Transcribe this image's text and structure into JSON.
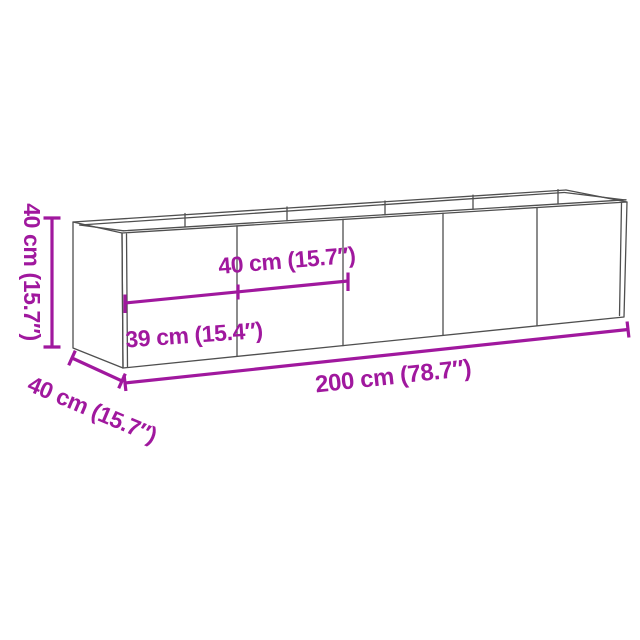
{
  "diagram": {
    "type": "product-dimension-drawing",
    "background": "#ffffff",
    "panel_count": 5,
    "dimensions": [
      {
        "id": "height",
        "label": "40 cm (15.7″)",
        "cm": 40,
        "inches": 15.7
      },
      {
        "id": "depth",
        "label": "40 cm (15.7″)",
        "cm": 40,
        "inches": 15.7
      },
      {
        "id": "panel_width",
        "label": "40 cm (15.7″)",
        "cm": 40,
        "inches": 15.7
      },
      {
        "id": "first_panel_width",
        "label": "39 cm (15.4″)",
        "cm": 39,
        "inches": 15.4
      },
      {
        "id": "length",
        "label": "200 cm (78.7″)",
        "cm": 200,
        "inches": 78.7
      }
    ]
  },
  "colors": {
    "dimension": "#A0189E",
    "outline": "#4F4F4F"
  }
}
